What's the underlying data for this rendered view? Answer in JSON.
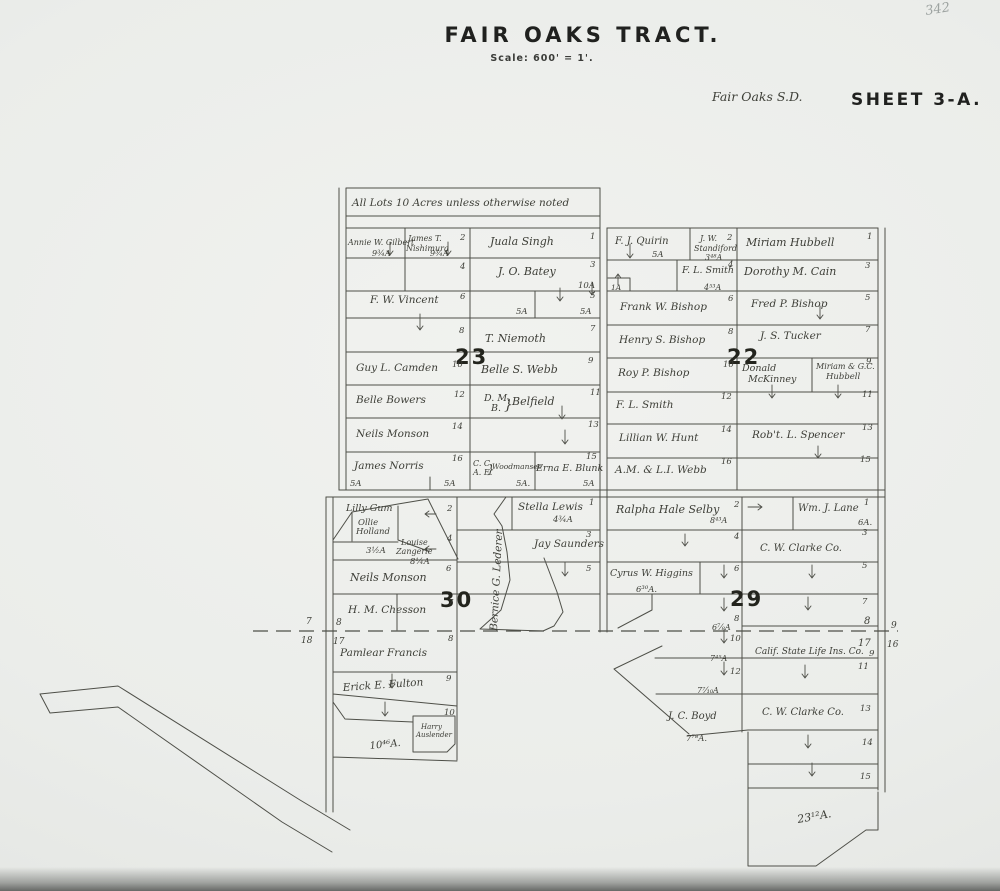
{
  "corner_number": "342",
  "header": {
    "title": "FAIR OAKS TRACT.",
    "scale": "Scale: 600' = 1'.",
    "district": "Fair Oaks S.D.",
    "sheet": "SHEET 3-A."
  },
  "note": "All Lots 10 Acres unless otherwise noted",
  "section_numbers": {
    "nw": "23",
    "ne": "22",
    "sw": "30",
    "se": "29"
  },
  "edge_numbers": {
    "left_outside_top": "7",
    "left_outside_bottom": "18",
    "left_inside_top": "8",
    "left_inside_bottom": "17",
    "right_inside_top": "8",
    "right_inside_bottom": "17",
    "right_outside_top": "9",
    "right_outside_bottom": "16"
  },
  "nw": {
    "gilbert": "Annie W. Gilbert",
    "gilbert_acres": "9¾A",
    "nishimura_1": "James T.",
    "nishimura_2": "Nishimura",
    "nishimura_acres": "9¾A",
    "lot2": "2",
    "singh": "Juala Singh",
    "lot1": "1",
    "lot4": "4",
    "batey": "J. O. Batey",
    "lot3": "3",
    "batey_acres": "10A",
    "vincent": "F. W. Vincent",
    "lot6": "6",
    "lot5": "5",
    "acres5w": "5A",
    "acres5e": "5A",
    "lot8": "8",
    "niemoth": "T. Niemoth",
    "lot7": "7",
    "camden": "Guy L. Camden",
    "lot10": "10",
    "webb": "Belle S. Webb",
    "lot9": "9",
    "bowers": "Belle Bowers",
    "lot12": "12",
    "belfield_dm": "D. M.",
    "belfield_b": "B.",
    "belfield_brace": "}",
    "belfield": "Belfield",
    "lot11": "11",
    "monson": "Neils Monson",
    "lot14": "14",
    "lot13": "13",
    "norris": "James Norris",
    "lot16": "16",
    "norris_a1": "5A",
    "norris_a2": "5A",
    "wood_cc": "C. C.",
    "wood_ae": "A. E.",
    "wood_brace": "}",
    "woodmansee": "Woodmansee",
    "wood_acres": "5A.",
    "blunk": "Erna E. Blunk",
    "lot15": "15",
    "blunk_acres": "5A"
  },
  "ne": {
    "quirin": "F. J. Quirin",
    "quirin_acres": "5A",
    "standiford_1": "J. W.",
    "standiford_2": "Standiford",
    "standiford_acres": "3⁴⁸A",
    "lot2": "2",
    "hubbell": "Miriam Hubbell",
    "lot1": "1",
    "smith4": "F. L. Smith",
    "lot4": "4",
    "smith4_acres": "4⁵³A",
    "cain": "Dorothy M. Cain",
    "lot3": "3",
    "one_acre": "1A",
    "bishop_frank": "Frank W. Bishop",
    "lot6": "6",
    "bishop_fred": "Fred P. Bishop",
    "lot5": "5",
    "bishop_henry": "Henry S. Bishop",
    "lot8": "8",
    "tucker": "J. S. Tucker",
    "lot7": "7",
    "bishop_roy": "Roy P. Bishop",
    "lot10": "10",
    "mckinney_1": "Donald",
    "mckinney_2": "McKinney",
    "hubbell2_1": "Miriam & G.C.",
    "hubbell2_2": "Hubbell",
    "lot9": "9",
    "lot11": "11",
    "smith12": "F. L. Smith",
    "lot12": "12",
    "hunt": "Lillian W. Hunt",
    "lot14": "14",
    "spencer": "Rob't. L. Spencer",
    "lot13": "13",
    "webb16": "A.M. & L.I. Webb",
    "lot16": "16",
    "lot15": "15"
  },
  "sw": {
    "gum": "Lilly Gum",
    "ollie": "Ollie",
    "holland": "Holland",
    "holland_acres": "3½A",
    "louise": "Louise",
    "zangerle": "Zangerle",
    "zangerle_acres": "8¼A",
    "lot2": "2",
    "lot4": "4",
    "lewis": "Stella Lewis",
    "lot1": "1",
    "lewis_acres": "4¾A",
    "saunders": "Jay Saunders",
    "lot3": "3",
    "lot5": "5",
    "monson": "Neils Monson",
    "lot6": "6",
    "lederer": "Bernice G. Lederer",
    "chesson": "H. M. Chesson",
    "lot7": "7",
    "francis": "Pamlear Francis",
    "lot8": "8",
    "fulton": "Erick E. Fulton",
    "lot9": "9",
    "lot10": "10",
    "auslender_1": "Harry",
    "auslender_2": "Auslender",
    "lot10_acres": "10⁴⁶A."
  },
  "se": {
    "selby": "Ralpha Hale Selby",
    "lot2": "2",
    "selby_acres": "8⁴³A",
    "lane": "Wm. J. Lane",
    "lot1": "1",
    "lane_acres": "6A.",
    "lot4": "4",
    "clarke3": "C. W. Clarke Co.",
    "lot3": "3",
    "higgins": "Cyrus W. Higgins",
    "higgins_acres": "6³⁰A.",
    "lot6": "6",
    "lot5": "5",
    "lot8": "8",
    "lot7": "7",
    "lot8_acres": "6⅞A",
    "lot10": "10",
    "lot10_acres": "7⁴⁵A",
    "calif": "Calif. State Life Ins. Co.",
    "lot9": "9",
    "lot12": "12",
    "lot12_acres": "7⁷⁄₁₀A",
    "lot11": "11",
    "boyd": "J. C. Boyd",
    "boyd_acres": "7⁷⁸A.",
    "clarke13": "C. W. Clarke Co.",
    "lot13": "13",
    "lot14": "14",
    "lot15": "15",
    "bottom_acres": "23¹²A."
  }
}
